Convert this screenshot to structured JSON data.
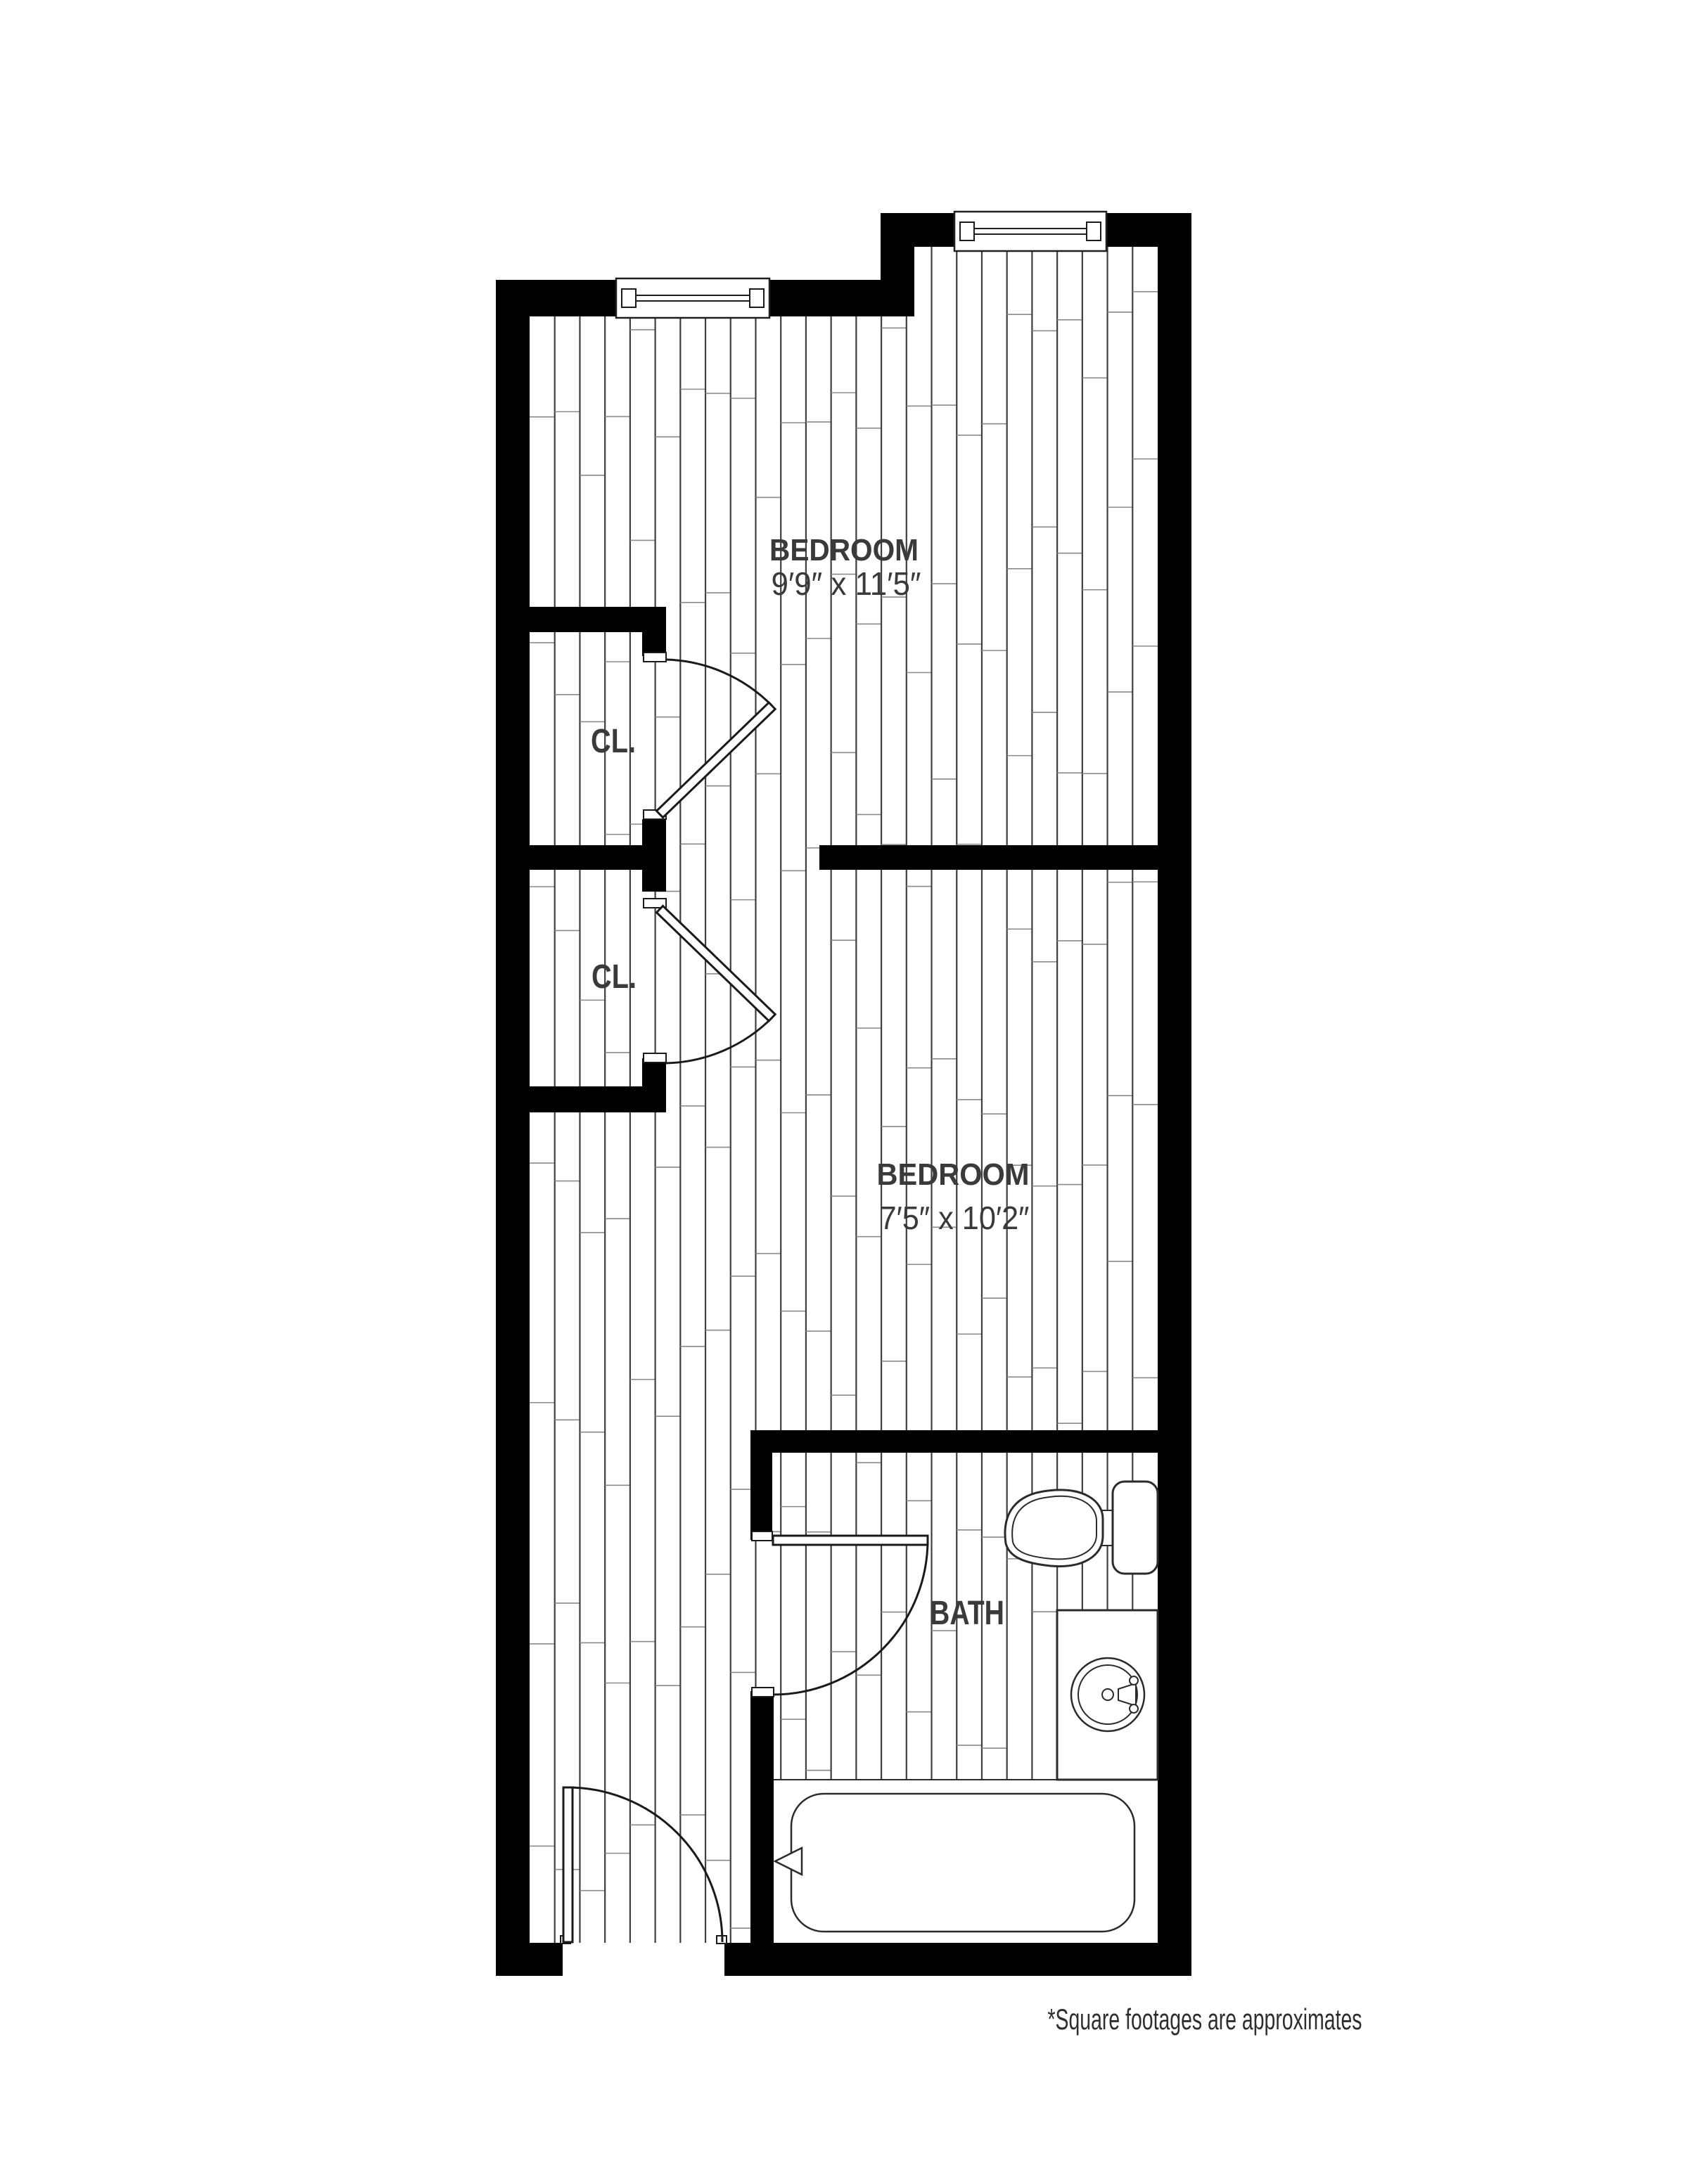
{
  "floor_plan": {
    "rooms": [
      {
        "id": "bedroom-1",
        "label": "BEDROOM",
        "dimensions": "9′9″ x 11′5″"
      },
      {
        "id": "bedroom-2",
        "label": "BEDROOM",
        "dimensions": "7′5″ x 10′2″"
      },
      {
        "id": "closet-1",
        "label": "CL."
      },
      {
        "id": "closet-2",
        "label": "CL."
      },
      {
        "id": "bath",
        "label": "BATH"
      }
    ],
    "footnote": "*Square footages are approximates",
    "fixtures": [
      "toilet",
      "sink-vanity",
      "bathtub",
      "tub-faucet",
      "window",
      "window",
      "closet-door",
      "closet-door",
      "bath-door",
      "entry-door"
    ],
    "colors": {
      "wall": "#000000",
      "background": "#ffffff",
      "plank_line": "#3f3f3f",
      "plank_joint": "#8a8a8a",
      "label_text": "#3a3a38",
      "footnote_text": "#2e2e2c"
    }
  }
}
